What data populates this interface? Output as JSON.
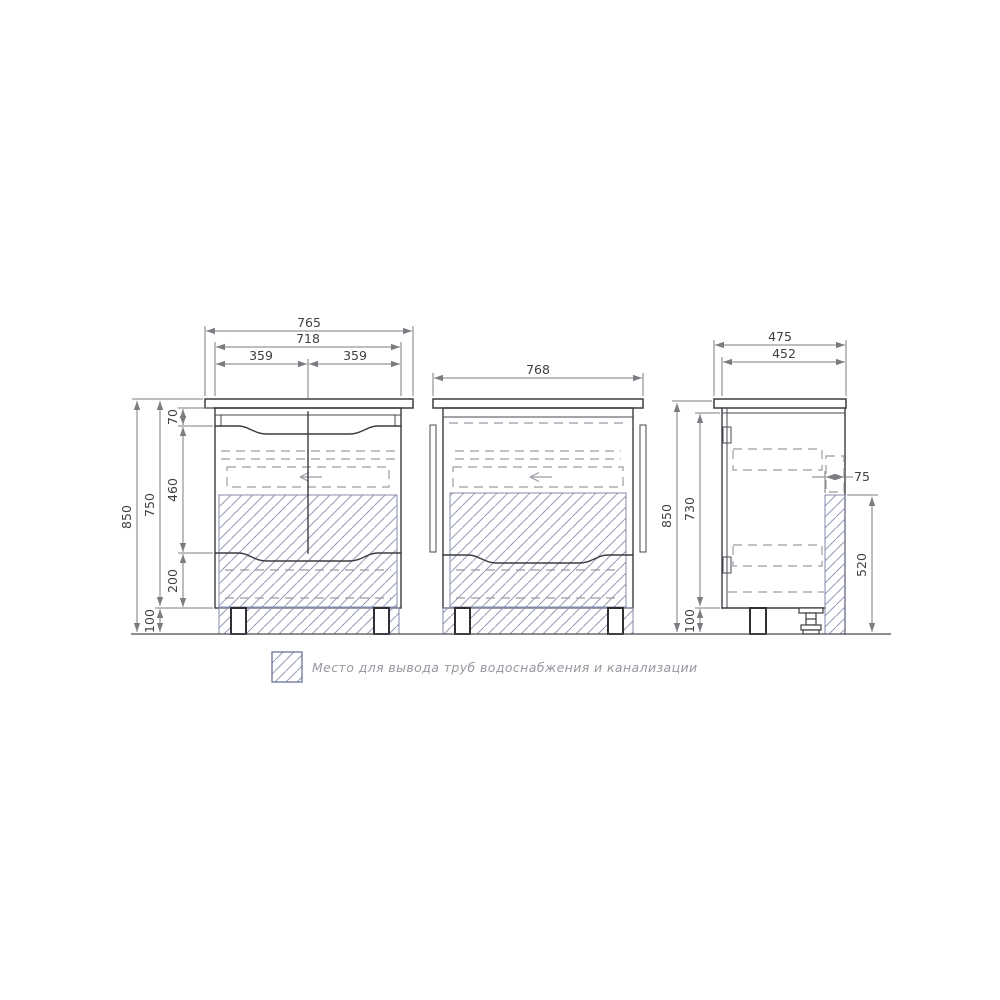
{
  "dims": {
    "front": {
      "total_width": "765",
      "carcass_width": "718",
      "half_left": "359",
      "half_right": "359",
      "total_height": "850",
      "body_height": "750",
      "top_gap": "70",
      "middle_zone": "460",
      "bottom_drawer": "200",
      "leg_height": "100"
    },
    "back": {
      "total_width": "768"
    },
    "side": {
      "total_depth": "475",
      "carcass_depth": "452",
      "total_height": "850",
      "body_height": "730",
      "leg_height": "100",
      "pipe_zone_width": "75",
      "pipe_zone_height": "520"
    }
  },
  "legend": {
    "text": "Место для вывода труб водоснабжения и канализации"
  },
  "colors": {
    "outline": "#3c3c41",
    "dimension": "#7c7c82",
    "dashed": "#9b9ba3",
    "hatch": "#959bb6",
    "legend_text": "#97979f",
    "background": "#ffffff"
  }
}
